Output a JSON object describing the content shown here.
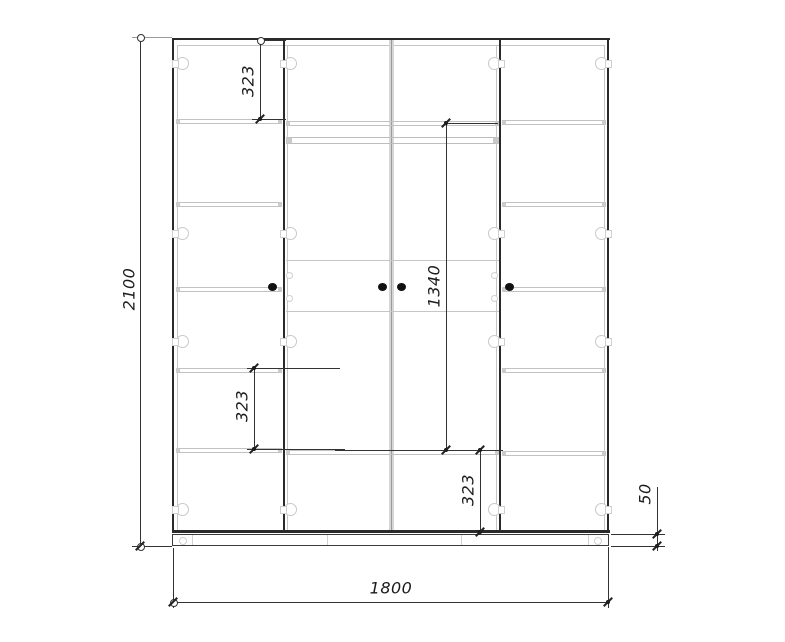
{
  "colors": {
    "background": "#ffffff",
    "carcass_line": "#2a2a2a",
    "panel_line": "#c6c6c6",
    "dimension_line": "#333333",
    "handle_fill": "#111111"
  },
  "dimensions": {
    "overall_height": "2100",
    "overall_width": "1800",
    "plinth_height": "50",
    "top_shelf_spacing": "323",
    "hanging_section_height": "1340",
    "lower_left_shelf_spacing": "323",
    "bottom_middle_shelf_spacing": "323"
  }
}
